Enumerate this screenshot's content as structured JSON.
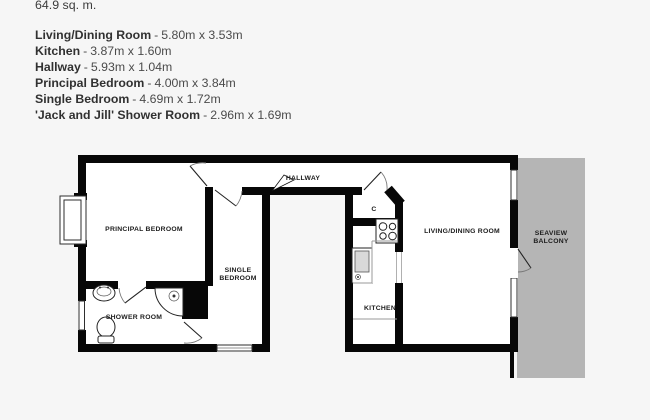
{
  "colors": {
    "page_bg": "#f6f6f6",
    "room_fill": "#ffffff",
    "wall": "#070707",
    "balcony_fill": "#b5b5b5",
    "label": "#1c1c1c",
    "door": "#777777",
    "leaf": "#222222"
  },
  "summary": {
    "area": "64.9 sq. m.",
    "separator": "-",
    "rooms": [
      {
        "name": "Living/Dining Room",
        "dims": "5.80m x 3.53m"
      },
      {
        "name": "Kitchen",
        "dims": "3.87m x 1.60m"
      },
      {
        "name": "Hallway",
        "dims": "5.93m x 1.04m"
      },
      {
        "name": "Principal Bedroom",
        "dims": "4.00m x 3.84m"
      },
      {
        "name": "Single Bedroom",
        "dims": "4.69m x 1.72m"
      },
      {
        "name": "'Jack and Jill' Shower Room",
        "dims": "2.96m x 1.69m"
      }
    ]
  },
  "floorplan": {
    "labels": {
      "principal_bedroom": "PRINCIPAL BEDROOM",
      "single_bedroom_line1": "SINGLE",
      "single_bedroom_line2": "BEDROOM",
      "shower_room": "SHOWER ROOM",
      "hallway": "HALLWAY",
      "cupboard": "C",
      "kitchen": "KITCHEN",
      "living_dining": "LIVING/DINING ROOM",
      "balcony_line1": "SEAVIEW",
      "balcony_line2": "BALCONY"
    }
  }
}
